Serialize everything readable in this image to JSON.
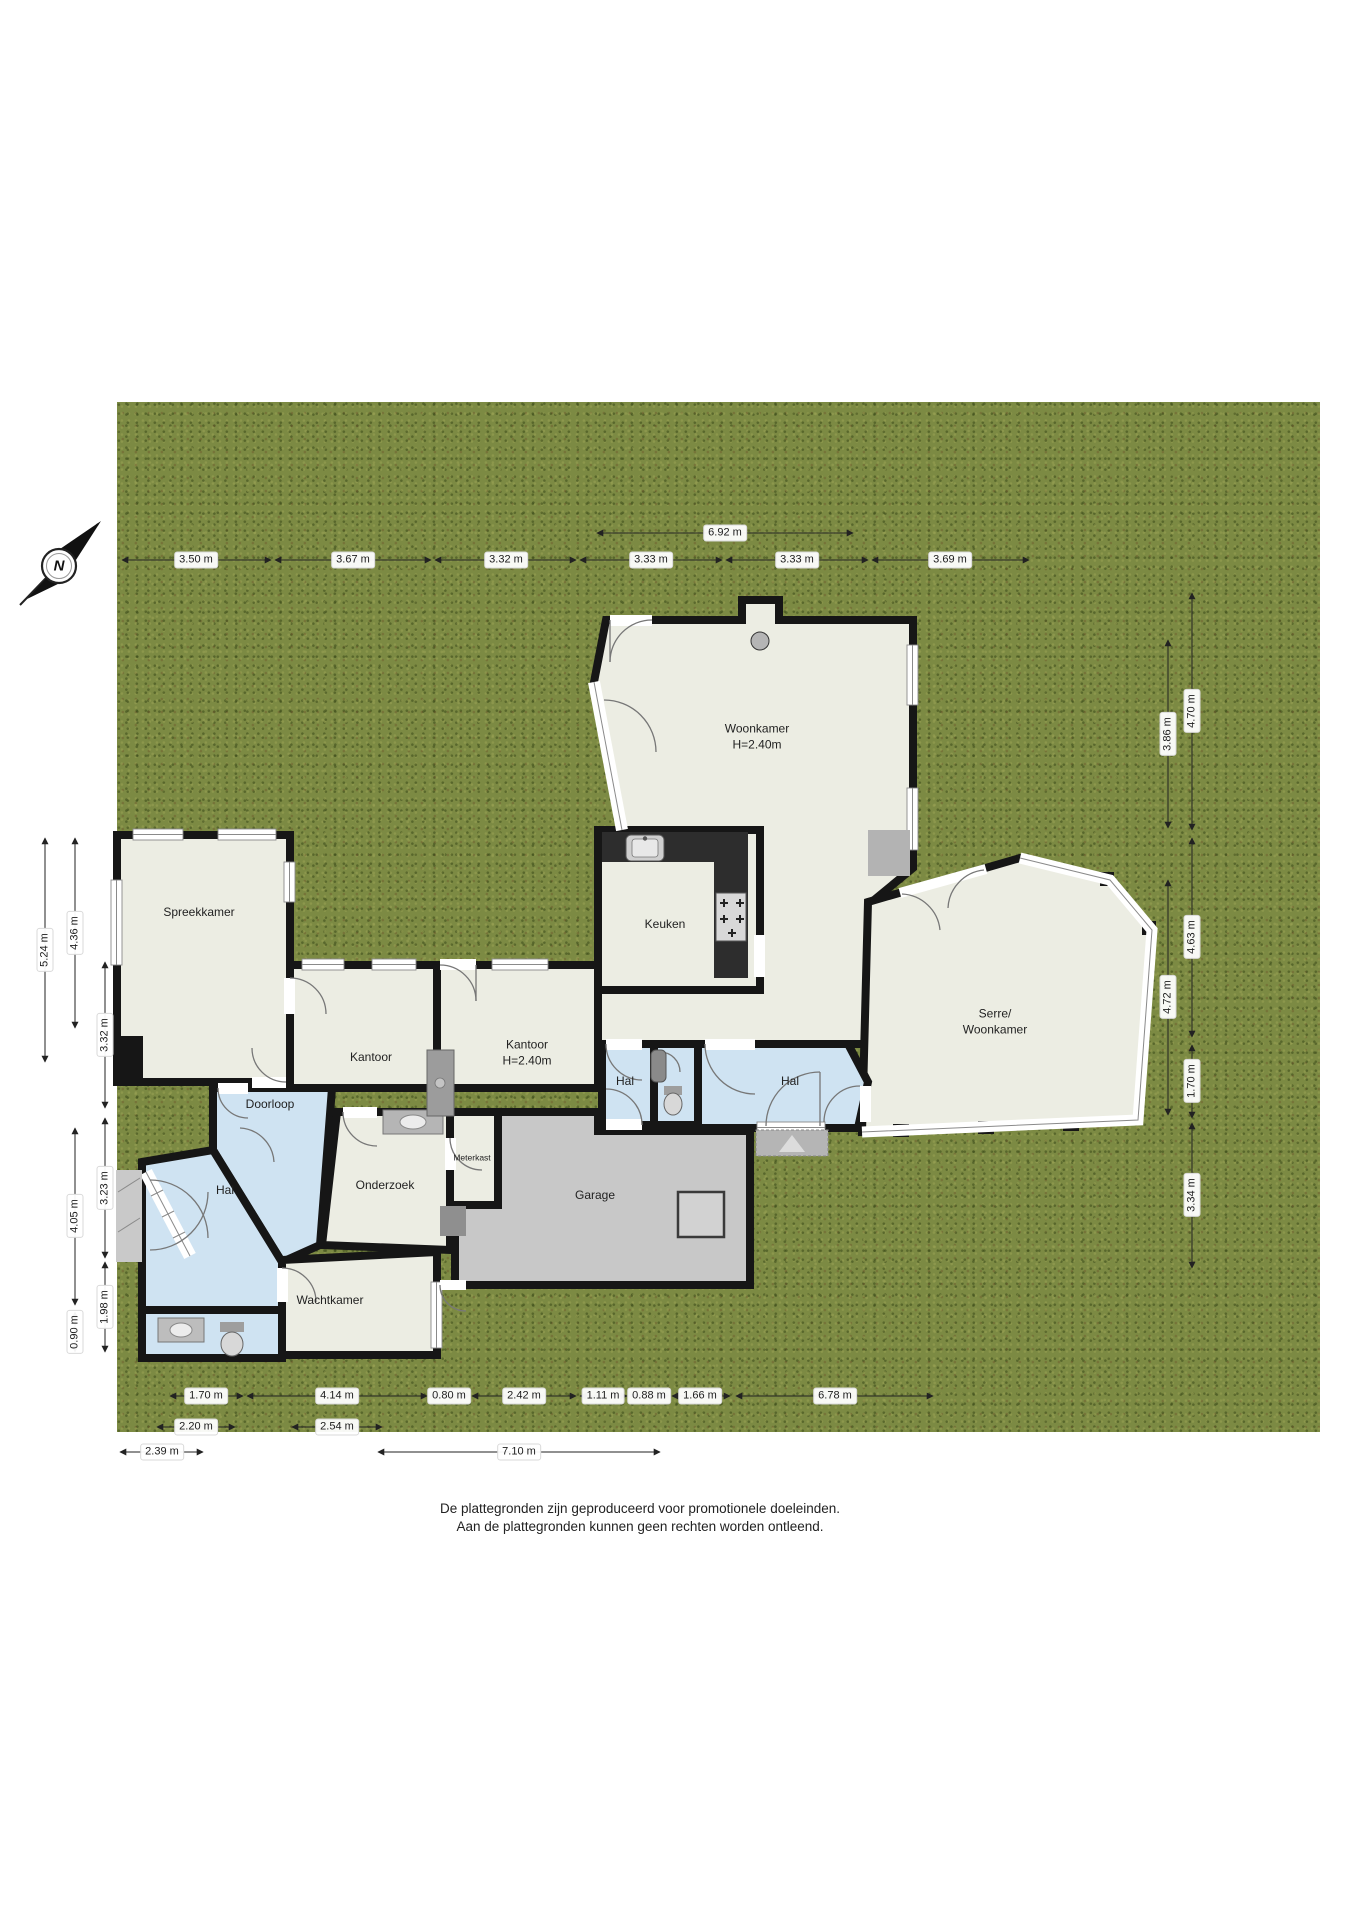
{
  "compass": {
    "label": "N"
  },
  "rooms": [
    {
      "id": "woonkamer",
      "label": "Woonkamer",
      "sub": "H=2.40m"
    },
    {
      "id": "keuken",
      "label": "Keuken"
    },
    {
      "id": "serre",
      "label": "Serre/",
      "sub": "Woonkamer"
    },
    {
      "id": "spreekkamer",
      "label": "Spreekkamer"
    },
    {
      "id": "kantoor-links",
      "label": "Kantoor"
    },
    {
      "id": "kantoor-rechts",
      "label": "Kantoor",
      "sub": "H=2.40m"
    },
    {
      "id": "hal-klein",
      "label": "Hal"
    },
    {
      "id": "hal-entree",
      "label": "Hal"
    },
    {
      "id": "doorloop",
      "label": "Doorloop"
    },
    {
      "id": "onderzoek",
      "label": "Onderzoek"
    },
    {
      "id": "meterkast",
      "label": "Meterkast"
    },
    {
      "id": "garage",
      "label": "Garage"
    },
    {
      "id": "hal-linksonder",
      "label": "Hal"
    },
    {
      "id": "wachtkamer",
      "label": "Wachtkamer"
    }
  ],
  "dimensions": {
    "top_overall": "6.92 m",
    "top_row": [
      "3.50 m",
      "3.67 m",
      "3.32 m",
      "3.33 m",
      "3.33 m",
      "3.69 m"
    ],
    "left_col1": [
      "5.24 m"
    ],
    "left_col2": [
      "4.36 m",
      "4.05 m",
      "0.90 m"
    ],
    "left_col3": [
      "3.32 m",
      "3.23 m",
      "1.98 m"
    ],
    "right_inner": [
      "3.86 m",
      "4.72 m"
    ],
    "right_outer": [
      "4.70 m",
      "4.63 m",
      "1.70 m",
      "3.34 m"
    ],
    "bottom_row1": [
      "1.70 m",
      "4.14 m",
      "0.80 m",
      "2.42 m",
      "1.11 m",
      "0.88 m",
      "1.66 m",
      "6.78 m"
    ],
    "bottom_row2": [
      "2.20 m",
      "2.54 m"
    ],
    "bottom_row3": [
      "2.39 m",
      "7.10 m"
    ]
  },
  "footer": {
    "line1": "De plattegronden zijn geproduceerd voor promotionele doeleinden.",
    "line2": "Aan de plattegronden kunnen geen rechten worden ontleend."
  },
  "colors": {
    "grass": "#7c8a43",
    "wall": "#161616",
    "room_floor": "#ecede3",
    "hall_floor": "#cfe3f2",
    "garage_floor": "#c8c8c8",
    "kitchen_counter": "#2d2d2d"
  }
}
